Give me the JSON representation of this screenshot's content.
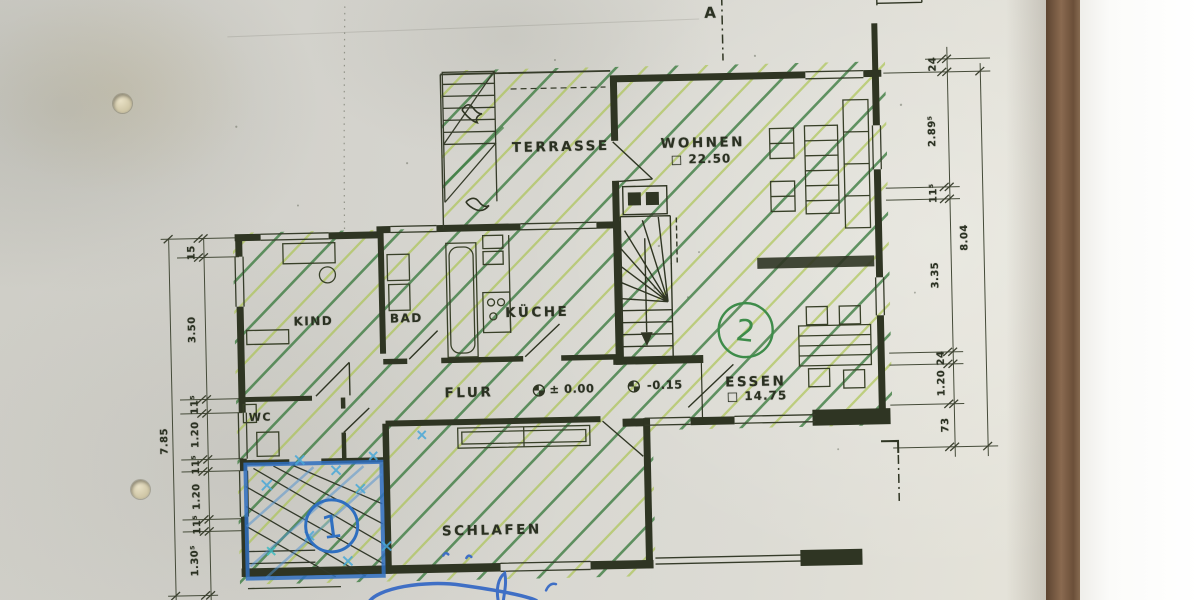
{
  "plan": {
    "section_marker": "A",
    "rooms": {
      "terrasse": {
        "label": "TERRASSE"
      },
      "wohnen": {
        "label": "WOHNEN",
        "area": "□ 22.50"
      },
      "kueche": {
        "label": "KÜCHE"
      },
      "bad": {
        "label": "BAD"
      },
      "kind": {
        "label": "KIND"
      },
      "wc": {
        "label": "WC"
      },
      "flur": {
        "label": "FLUR"
      },
      "essen": {
        "label": "ESSEN",
        "area": "□ 14.75"
      },
      "schlafen": {
        "label": "SCHLAFEN"
      }
    },
    "levels": {
      "ground": "± 0.00",
      "lower": "-0.15"
    },
    "markers": {
      "green_circle": "2",
      "blue_circle": "1"
    },
    "dimensions": {
      "left": {
        "overall": "7.85",
        "chain": [
          "15",
          "3.50",
          "11⁵",
          "1.20",
          "11⁵",
          "1.20",
          "11⁵",
          "1.30⁵"
        ]
      },
      "right": {
        "overall": "8.04",
        "chain": [
          "24",
          "2.89⁵",
          "11⁵",
          "3.35",
          "24",
          "1.20",
          "73"
        ]
      }
    },
    "colors": {
      "ink": "#2f3523",
      "hatch_green": "#3f7d43",
      "hatch_light_green": "#a9c34e",
      "marker_blue": "#2f6fc0",
      "marker_cyan": "#49a8d8"
    }
  }
}
